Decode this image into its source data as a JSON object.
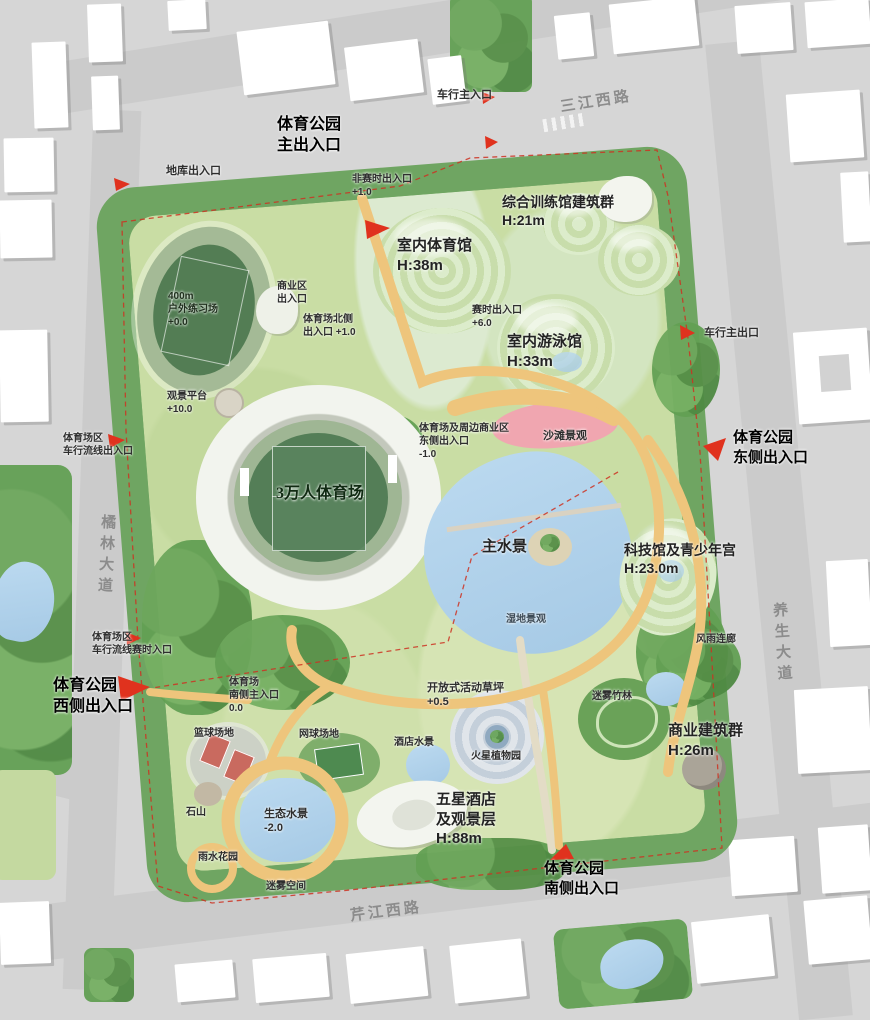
{
  "roads": {
    "top": "三江西路",
    "left": "橘林大道",
    "right": "养生大道",
    "bottom": "芹江西路"
  },
  "labels": {
    "park_main_entrance": "体育公园\n主出入口",
    "vehicle_main_entrance_top": "车行主入口",
    "garage_entrance": "地库出入口",
    "non_event_entrance": "非赛时出入口\n+1.0",
    "training_complex": "综合训练馆建筑群\nH:21m",
    "indoor_gym": "室内体育馆\nH:38m",
    "commercial_entrance": "商业区\n出入口",
    "stadium_north_entrance": "体育场北侧\n出入口 +1.0",
    "practice_field": "400m\n户外练习场\n+0.0",
    "event_entrance": "赛时出入口\n+6.0",
    "indoor_pool": "室内游泳馆\nH:33m",
    "vehicle_main_exit_right": "车行主出口",
    "viewing_platform": "观景平台\n+10.0",
    "stadium_commercial_east_entrance": "体育场及周边商业区\n东侧出入口\n-1.0",
    "beach": "沙滩景观",
    "park_east_entrance": "体育公园\n东侧出入口",
    "stadium_vehicle_entrance": "体育场区\n车行流线出入口",
    "stadium": "3万人体育场",
    "main_lake": "主水景",
    "science_youth_center": "科技馆及青少年宫\nH:23.0m",
    "wetland": "湿地景观",
    "rain_corridor": "风雨连廊",
    "stadium_vehicle_event_entrance": "体育场区\n车行流线赛时入口",
    "park_west_entrance": "体育公园\n西侧出入口",
    "stadium_south_entrance": "体育场\n南侧主入口\n0.0",
    "basketball_courts": "篮球场地",
    "tennis_courts": "网球场地",
    "open_lawn": "开放式活动草坪\n+0.5",
    "mist_bamboo": "迷雾竹林",
    "hotel_water": "酒店水景",
    "mars_garden": "火星植物园",
    "commercial_buildings": "商业建筑群\nH:26m",
    "eco_water": "生态水景\n-2.0",
    "stone_hill": "石山",
    "rain_garden": "雨水花园",
    "hotel": "五星酒店\n及观景层\nH:88m",
    "mist_space": "迷雾空间",
    "park_south_entrance": "体育公园\n南侧出入口"
  },
  "colors": {
    "road": "#cbcbcb",
    "building": "#ffffff",
    "tree_belt": "#6fa562",
    "lawn": "#c9dda4",
    "water": "#aecfe8",
    "beach_pink": "#f0a6b0",
    "path_yellow": "#eec57c",
    "boundary_red": "#cc3322",
    "arrow_red": "#e0321e",
    "track_green": "#527c52"
  }
}
